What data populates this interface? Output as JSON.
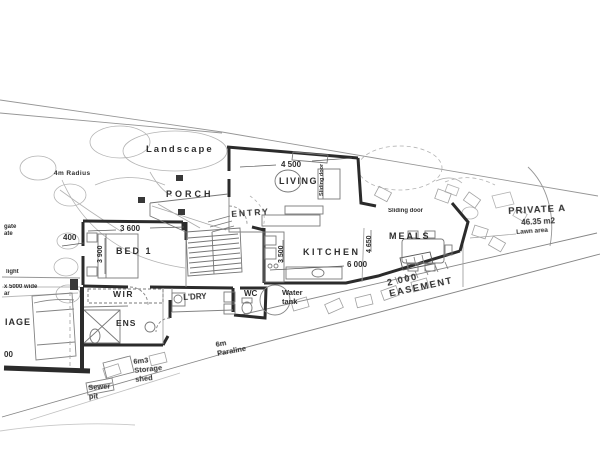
{
  "colors": {
    "ink": "#2e2e2e",
    "wall": "#1a1a1a",
    "site_line": "#8f8f8f",
    "paper": "#ffffff"
  },
  "plan": {
    "rooms": [
      "PORCH",
      "ENTRY",
      "LIVING",
      "MEALS",
      "KITCHEN",
      "BED 1",
      "WIR",
      "ENS",
      "L'DRY",
      "WC"
    ],
    "site_features": [
      "Landscape",
      "4m Radius",
      "Lawn area",
      "Water tank",
      "2 000 EASEMENT",
      "6m Paraline",
      "6m3 Storage shed",
      "Sewer pit",
      "PRIVATE A",
      "46.35 m2"
    ],
    "dimensions": [
      "4 500",
      "6 000",
      "4 650",
      "3 500",
      "3 600",
      "3 900",
      "400",
      "x 5000 wide",
      "2 000"
    ]
  },
  "labels": [
    {
      "id": "landscape",
      "text": "Landscape",
      "x": 146,
      "y": 144,
      "size": 9.5,
      "ls": 2,
      "w": 700
    },
    {
      "id": "radius-4m",
      "text": "4m Radius",
      "x": 54,
      "y": 170,
      "size": 6.5,
      "ls": 0.4,
      "w": 700
    },
    {
      "id": "porch",
      "text": "PORCH",
      "x": 166,
      "y": 189,
      "size": 9,
      "ls": 3,
      "w": 700
    },
    {
      "id": "entry",
      "text": "ENTRY",
      "x": 231,
      "y": 209,
      "size": 8.5,
      "ls": 2,
      "rot": -4,
      "w": 700
    },
    {
      "id": "dim-4500",
      "text": "4 500",
      "x": 281,
      "y": 160,
      "size": 8,
      "w": 600
    },
    {
      "id": "living",
      "text": "LIVING",
      "x": 279,
      "y": 176,
      "size": 9,
      "ls": 1.5,
      "w": 700
    },
    {
      "id": "sliding-door-vertical",
      "text": "Sliding door",
      "x": 319,
      "y": 196,
      "size": 5.5,
      "rot": -90,
      "w": 600
    },
    {
      "id": "sliding-door",
      "text": "Sliding door",
      "x": 388,
      "y": 208,
      "size": 6,
      "w": 700
    },
    {
      "id": "meals",
      "text": "MEALS",
      "x": 389,
      "y": 231,
      "size": 9,
      "ls": 2,
      "w": 700
    },
    {
      "id": "kitchen",
      "text": "KITCHEN",
      "x": 303,
      "y": 247,
      "size": 9,
      "ls": 2.5,
      "w": 700
    },
    {
      "id": "dim-6000",
      "text": "6 000",
      "x": 347,
      "y": 260,
      "size": 8,
      "w": 600
    },
    {
      "id": "dim-4650",
      "text": "4 650",
      "x": 366,
      "y": 253,
      "size": 7,
      "rot": -90,
      "w": 600
    },
    {
      "id": "dim-3500",
      "text": "3 500",
      "x": 278,
      "y": 263,
      "size": 7,
      "rot": -90,
      "w": 600
    },
    {
      "id": "private-area",
      "text": "PRIVATE A",
      "x": 508,
      "y": 206,
      "size": 9.5,
      "ls": 1,
      "rot": -3,
      "w": 700
    },
    {
      "id": "private-area-m2",
      "text": "46.35 m2",
      "x": 521,
      "y": 218,
      "size": 8,
      "rot": -3,
      "w": 600
    },
    {
      "id": "lawn-area",
      "text": "Lawn area",
      "x": 516,
      "y": 229,
      "size": 6.5,
      "rot": -4,
      "w": 600
    },
    {
      "id": "dim-400",
      "text": "400",
      "x": 63,
      "y": 233,
      "size": 8,
      "w": 700
    },
    {
      "id": "dim-3600",
      "text": "3 600",
      "x": 120,
      "y": 224,
      "size": 8,
      "w": 600
    },
    {
      "id": "bed1",
      "text": "BED 1",
      "x": 116,
      "y": 246,
      "size": 9,
      "ls": 2,
      "w": 700
    },
    {
      "id": "dim-3900",
      "text": "3 900",
      "x": 97,
      "y": 263,
      "size": 7,
      "rot": -90,
      "w": 600
    },
    {
      "id": "wir",
      "text": "WIR",
      "x": 113,
      "y": 289,
      "size": 8.5,
      "ls": 1.5,
      "w": 700
    },
    {
      "id": "ldry",
      "text": "L'DRY",
      "x": 183,
      "y": 293,
      "size": 8,
      "rot": -3,
      "w": 700
    },
    {
      "id": "wc",
      "text": "WC",
      "x": 244,
      "y": 289,
      "size": 8,
      "w": 700
    },
    {
      "id": "ens",
      "text": "ENS",
      "x": 116,
      "y": 318,
      "size": 8.5,
      "ls": 1,
      "w": 700
    },
    {
      "id": "water-tank",
      "text": "Water\ntank",
      "x": 282,
      "y": 289,
      "size": 7.5,
      "w": 700
    },
    {
      "id": "easement",
      "text": "2 000\nEASEMENT",
      "x": 386,
      "y": 278,
      "size": 9.5,
      "ls": 1.5,
      "rot": -12,
      "w": 600
    },
    {
      "id": "paraline-6m",
      "text": "6m\nParaline",
      "x": 215,
      "y": 341,
      "size": 7.5,
      "rot": -10,
      "w": 700
    },
    {
      "id": "storage-shed",
      "text": "6m3\nStorage\nshed",
      "x": 133,
      "y": 358,
      "size": 7.5,
      "rot": -6,
      "w": 700
    },
    {
      "id": "sewer-pit",
      "text": "Sewer\npit",
      "x": 88,
      "y": 384,
      "size": 7.5,
      "rot": -4,
      "w": 700
    },
    {
      "id": "gate",
      "text": "gate\nate",
      "x": 4,
      "y": 224,
      "size": 6,
      "w": 700
    },
    {
      "id": "light",
      "text": "light",
      "x": 6,
      "y": 269,
      "size": 6,
      "w": 700
    },
    {
      "id": "wide-5000",
      "text": "x 5000 wide\nar",
      "x": 4,
      "y": 284,
      "size": 6,
      "w": 700
    },
    {
      "id": "iage",
      "text": "IAGE",
      "x": 5,
      "y": 317,
      "size": 9,
      "ls": 1,
      "w": 700
    },
    {
      "id": "num-00",
      "text": "00",
      "x": 4,
      "y": 350,
      "size": 8,
      "w": 700
    }
  ]
}
